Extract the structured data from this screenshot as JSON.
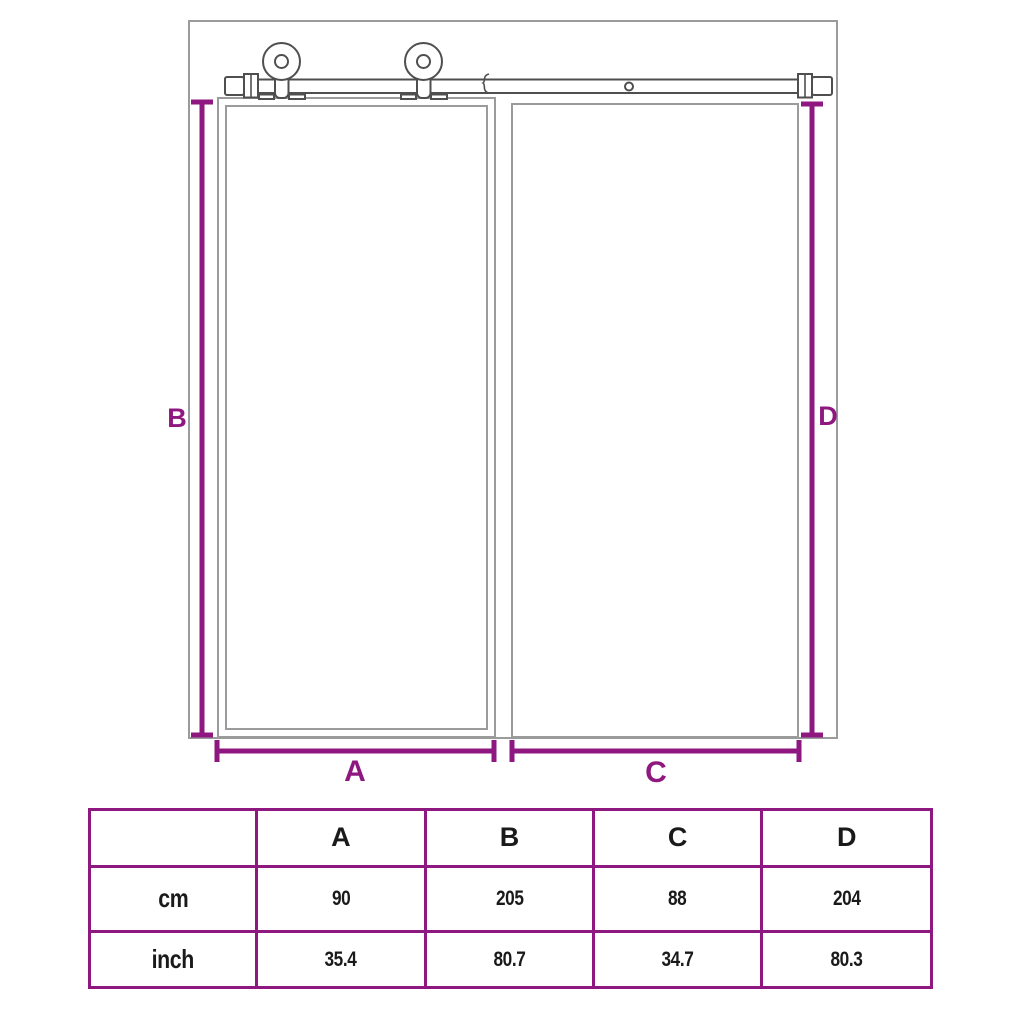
{
  "colors": {
    "dimension": "#8E187F",
    "table_border": "#8E187F",
    "outline": "#9B9B9B",
    "hardware": "#4F4F4F",
    "text": "#1A1A1A",
    "background": "#FFFFFF"
  },
  "diagram": {
    "description": "Sliding barn door on wall-mounted rail with two rollers, next to doorway opening",
    "labels": {
      "a": "A",
      "b": "B",
      "c": "C",
      "d": "D"
    }
  },
  "table": {
    "headers": [
      "",
      "A",
      "B",
      "C",
      "D"
    ],
    "rows": [
      {
        "label": "cm",
        "values": [
          "90",
          "205",
          "88",
          "204"
        ]
      },
      {
        "label": "inch",
        "values": [
          "35.4",
          "80.7",
          "34.7",
          "80.3"
        ]
      }
    ]
  }
}
